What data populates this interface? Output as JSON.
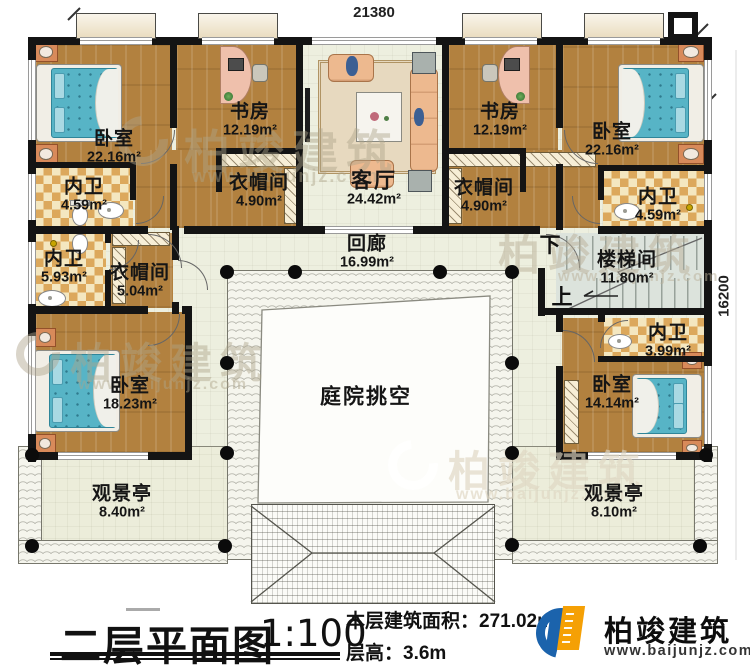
{
  "plan": {
    "dimension_top": "21380",
    "dimension_right": "16200",
    "stair_down": "下",
    "stair_up": "上"
  },
  "rooms": [
    {
      "id": "bedroom-top-left",
      "label": "卧室",
      "area": "22.16m²"
    },
    {
      "id": "study-left",
      "label": "书房",
      "area": "12.19m²"
    },
    {
      "id": "living-room",
      "label": "客厅",
      "area": "24.42m²"
    },
    {
      "id": "study-right",
      "label": "书房",
      "area": "12.19m²"
    },
    {
      "id": "bedroom-top-right",
      "label": "卧室",
      "area": "22.16m²"
    },
    {
      "id": "bath-top-left",
      "label": "内卫",
      "area": "4.59m²"
    },
    {
      "id": "closet-top-left",
      "label": "衣帽间",
      "area": "4.90m²"
    },
    {
      "id": "closet-top-right",
      "label": "衣帽间",
      "area": "4.90m²"
    },
    {
      "id": "bath-top-right",
      "label": "内卫",
      "area": "4.59m²"
    },
    {
      "id": "bath-mid-left",
      "label": "内卫",
      "area": "5.93m²"
    },
    {
      "id": "closet-mid-left",
      "label": "衣帽间",
      "area": "5.04m²"
    },
    {
      "id": "corridor",
      "label": "回廊",
      "area": "16.99m²"
    },
    {
      "id": "stairwell",
      "label": "楼梯间",
      "area": "11.80m²"
    },
    {
      "id": "bedroom-bottom-left",
      "label": "卧室",
      "area": "18.23m²"
    },
    {
      "id": "bath-bottom-right",
      "label": "内卫",
      "area": "3.99m²"
    },
    {
      "id": "bedroom-bottom-right",
      "label": "卧室",
      "area": "14.14m²"
    },
    {
      "id": "courtyard-void",
      "label": "庭院挑空",
      "area": ""
    },
    {
      "id": "pavilion-left",
      "label": "观景亭",
      "area": "8.40m²"
    },
    {
      "id": "pavilion-right",
      "label": "观景亭",
      "area": "8.10m²"
    }
  ],
  "title_block": {
    "title": "二层平面图",
    "scale": "1:100",
    "area_label": "本层建筑面积：",
    "area_value": "271.02m²",
    "height_label": "层高：",
    "height_value": "3.6m"
  },
  "logo": {
    "name": "柏竣建筑",
    "website": "www.baijunjz.com"
  },
  "watermark": {
    "brand": "柏竣建筑",
    "website": "www.baijunjz.com"
  },
  "colors": {
    "wall": "#141414",
    "wood_floor": "#b2813f",
    "bath_tile": "#dca85c",
    "light_floor": "#edefdf",
    "stair_floor": "#dce3dc",
    "bed": "#57b4c6",
    "sofa": "#edb98f",
    "logo_blue": "#1b63ac",
    "logo_orange": "#f5a005"
  }
}
